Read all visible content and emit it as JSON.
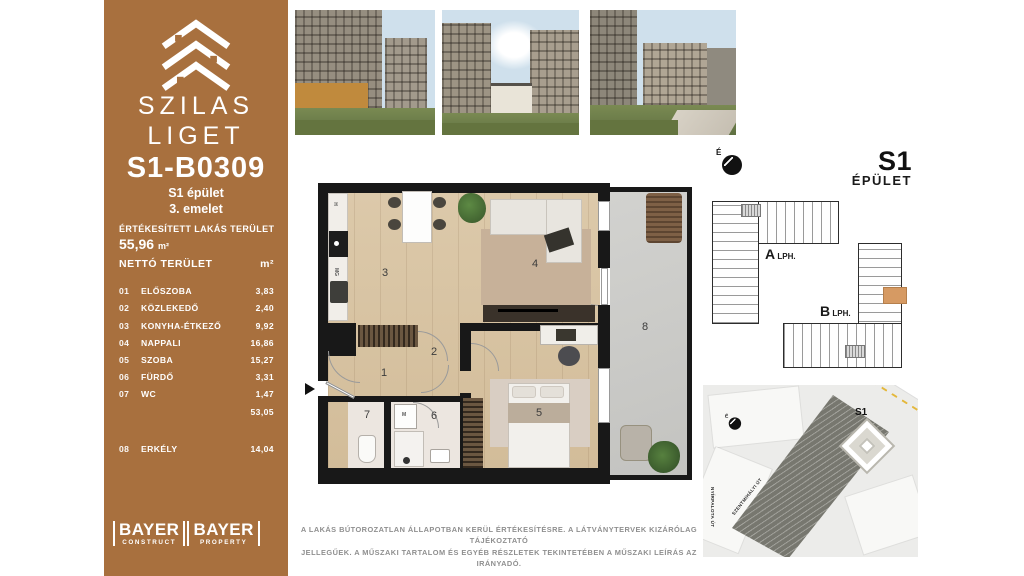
{
  "colors": {
    "accent_brown": "#A8703E",
    "unit_highlight": "#D69A63",
    "wall_black": "#181818"
  },
  "sidebar": {
    "brand": {
      "line1": "SZILAS",
      "line2": "LIGET"
    },
    "unit_id": "S1-B0309",
    "building": "S1 épület",
    "floor": "3. emelet",
    "sold_area_label": "ÉRTÉKESÍTETT LAKÁS TERÜLET",
    "sold_area_value": "55,96",
    "sold_area_unit": "m²",
    "table": {
      "header_label": "NETTÓ TERÜLET",
      "header_unit": "m²",
      "rows": [
        {
          "no": "01",
          "name": "ELŐSZOBA",
          "area": "3,83"
        },
        {
          "no": "02",
          "name": "KÖZLEKEDŐ",
          "area": "2,40"
        },
        {
          "no": "03",
          "name": "KONYHA-ÉTKEZŐ",
          "area": "9,92"
        },
        {
          "no": "04",
          "name": "NAPPALI",
          "area": "16,86"
        },
        {
          "no": "05",
          "name": "SZOBA",
          "area": "15,27"
        },
        {
          "no": "06",
          "name": "FÜRDŐ",
          "area": "3,31"
        },
        {
          "no": "07",
          "name": "WC",
          "area": "1,47"
        }
      ],
      "subtotal": "53,05",
      "extra_row": {
        "no": "08",
        "name": "ERKÉLY",
        "area": "14,04"
      }
    },
    "logos": [
      {
        "name": "BAYER",
        "sub": "CONSTRUCT"
      },
      {
        "name": "BAYER",
        "sub": "PROPERTY"
      }
    ]
  },
  "header_right": {
    "compass_label": "É",
    "building_code": "S1",
    "building_label": "ÉPÜLET"
  },
  "building_plan": {
    "stair_a": "A",
    "stair_a_sub": "LPH.",
    "stair_b": "B",
    "stair_b_sub": "LPH."
  },
  "site_map": {
    "building_marker": "S1",
    "street_1": "SZENTMIHÁLYI ÚT",
    "street_2": "NYÍRPALOTA ÚT",
    "compass_label": "É"
  },
  "floorplan": {
    "labels": {
      "r1": "1",
      "r2": "2",
      "r3": "3",
      "r4": "4",
      "r5": "5",
      "r6": "6",
      "r7": "7",
      "r8": "8"
    },
    "appliances": {
      "fridge": "H",
      "dishwasher": "MG",
      "washer": "M"
    }
  },
  "disclaimer": {
    "line1": "A LAKÁS BÚTOROZATLAN ÁLLAPOTBAN KERÜL ÉRTÉKESÍTÉSRE. A LÁTVÁNYTERVEK KIZÁRÓLAG TÁJÉKOZTATÓ",
    "line2": "JELLEGŰEK. A MŰSZAKI TARTALOM ÉS EGYÉB RÉSZLETEK TEKINTETÉBEN A MŰSZAKI LEÍRÁS AZ IRÁNYADÓ."
  }
}
